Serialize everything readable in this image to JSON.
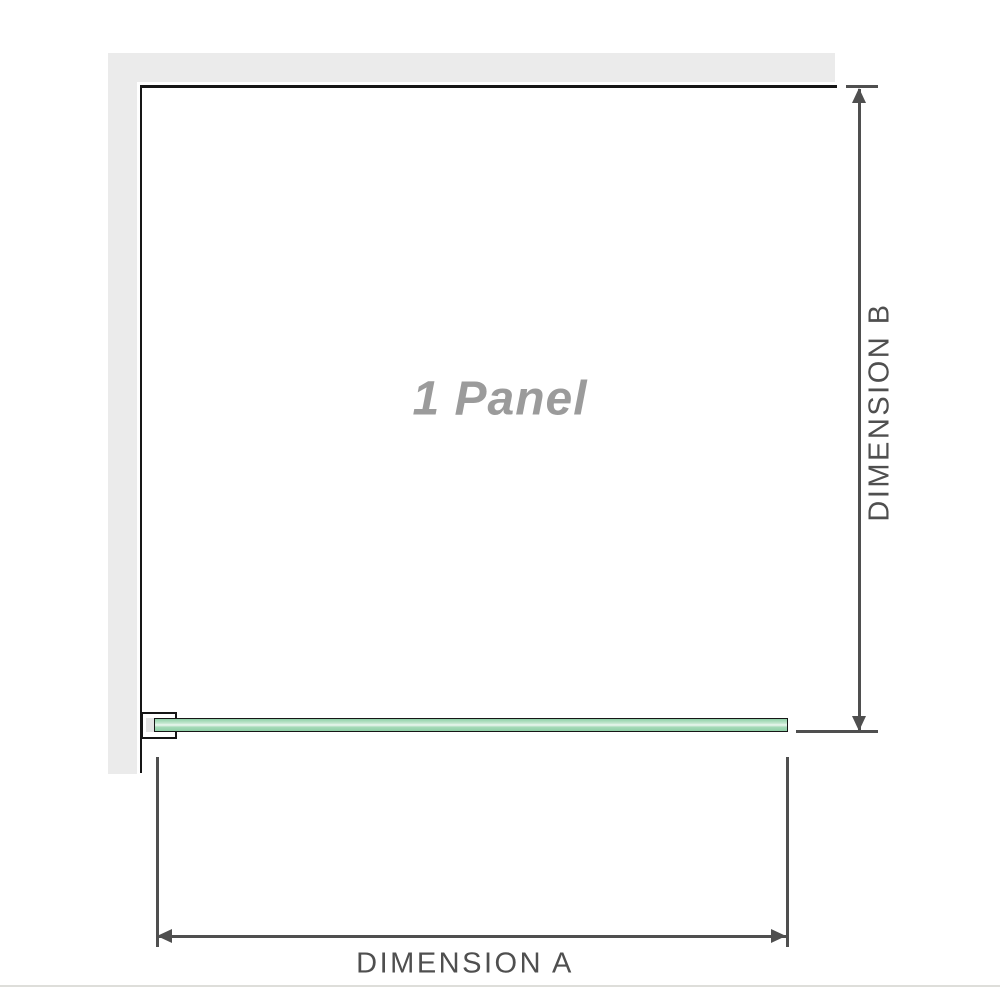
{
  "diagram": {
    "panel_label": "1 Panel",
    "dimension_a_label": "DIMENSION A",
    "dimension_b_label": "DIMENSION B"
  },
  "colors": {
    "background": "#ffffff",
    "wall_gray": "#ebebeb",
    "outline_black": "#161616",
    "dimension_gray": "#4f4f4f",
    "panel_label_gray": "#9b9b9b",
    "glass_green": "#8ecfa6",
    "glass_green_light": "#edf7f0",
    "bracket_fill": "#e4e4e4",
    "baseline_gray": "#dededa"
  }
}
